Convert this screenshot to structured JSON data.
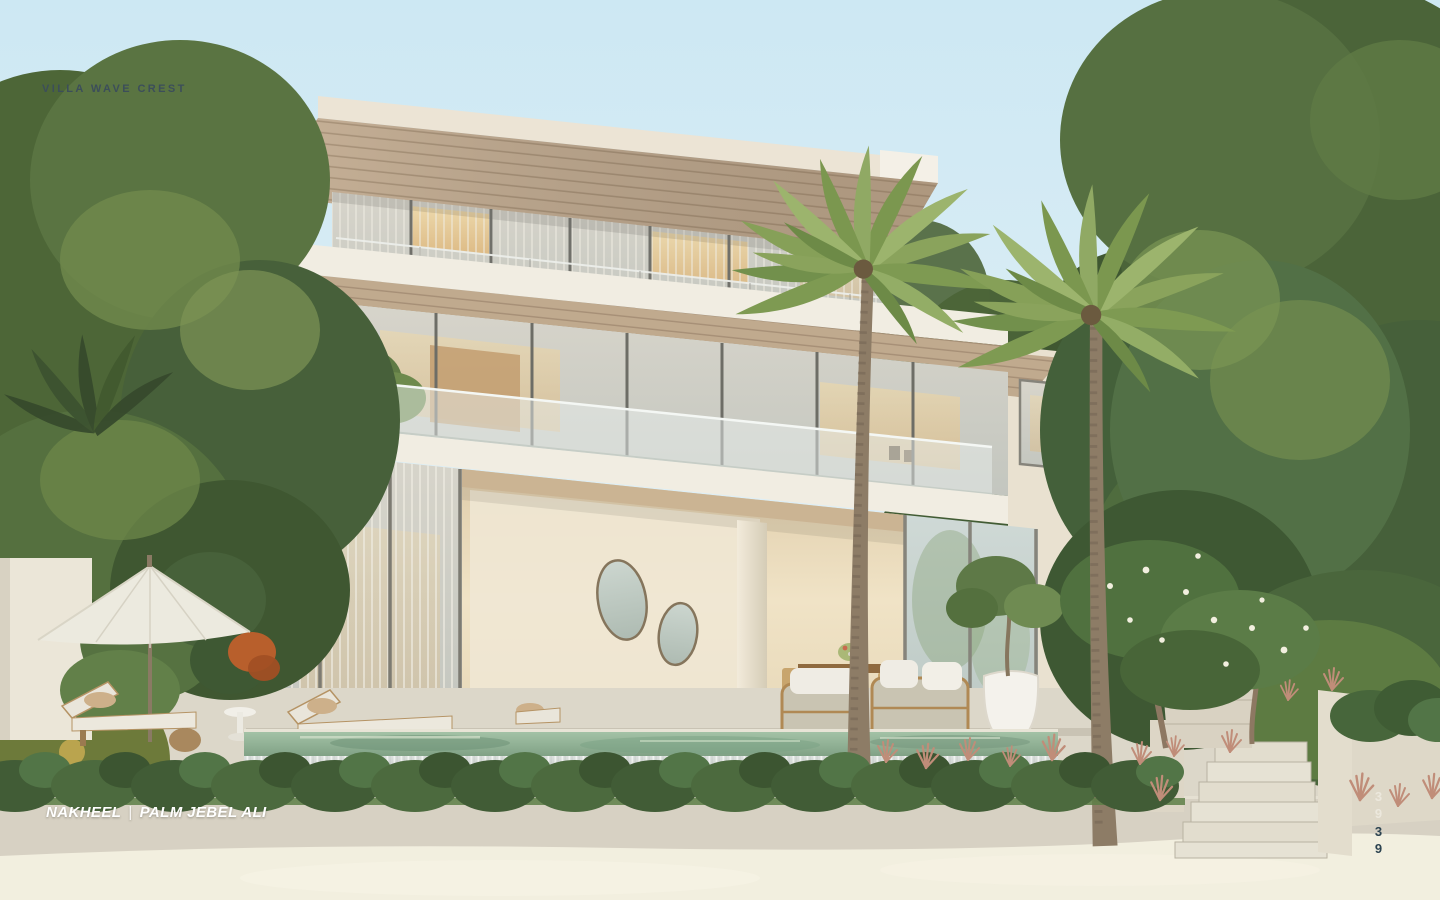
{
  "page": {
    "title": "VILLA WAVE CREST",
    "footer": {
      "brand": "NAKHEEL",
      "separator": "|",
      "location": "PALM JEBEL ALI"
    },
    "page_indicator": {
      "upper": "39",
      "lower": "39"
    }
  },
  "colors": {
    "sky_top": "#cde8f3",
    "sky_bottom": "#e2f0f6",
    "title": "#3c4e5a",
    "footer": "#ffffff",
    "page_upper": "#ece8dd",
    "page_lower": "#2c4350",
    "sand": "#f2efdf",
    "wall": "#d7d1c3",
    "deck": "#dcd7c9",
    "white_slab": "#f1ede2",
    "cream": "#ece4d4",
    "pool_water": "#93b296",
    "hedge_green": "#415c36",
    "wood_soffit": "#c8b298",
    "warm_glow": "#ead0a0",
    "foliage_dark": "#435c33",
    "foliage_mid": "#567141",
    "foliage_light": "#76914e"
  }
}
